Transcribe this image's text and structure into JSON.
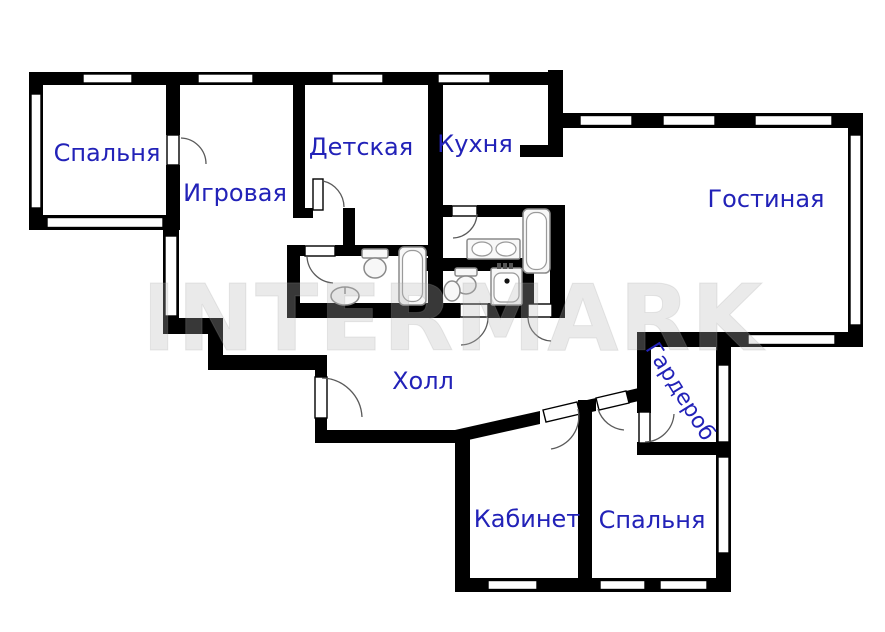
{
  "plan": {
    "title": "apartment-floor-plan",
    "rooms": {
      "bedroom_top_left": {
        "label": "Спальня"
      },
      "playroom": {
        "label": "Игровая"
      },
      "nursery": {
        "label": "Детская"
      },
      "kitchen": {
        "label": "Кухня"
      },
      "living_room": {
        "label": "Гостиная"
      },
      "hall": {
        "label": "Холл"
      },
      "study": {
        "label": "Кабинет"
      },
      "bedroom_bottom": {
        "label": "Спальня"
      },
      "wardrobe": {
        "label": "Гардероб"
      }
    },
    "watermark": {
      "text": "INTERMARK",
      "color": "rgba(185,185,185,0.30)"
    },
    "colors": {
      "wall": "#000000",
      "label": "#2222b8",
      "background": "#ffffff",
      "fixture_stroke": "#8a8a8a"
    }
  }
}
